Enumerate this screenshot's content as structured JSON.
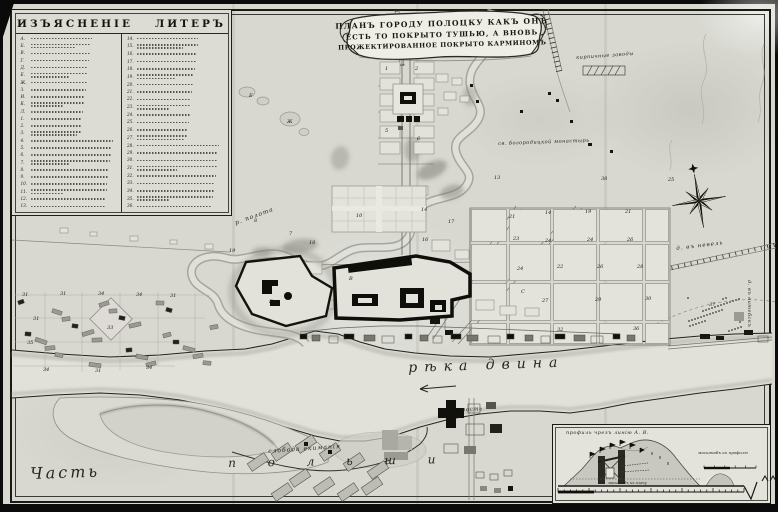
{
  "cartouche": {
    "line1": "ПЛАНЪ ГОРОДУ ПОЛОЦКУ КАКЪ ОНЪ",
    "line2": "ЕСТЬ ТО ПОКРЫТО ТУШЬЮ, А ВНОВЬ",
    "line3": "ПРОЖЕКТИРОВАННОЕ ПОКРЫТО КАРМИНОМЪ"
  },
  "legend": {
    "title_word1": "ИЗЪЯСНЕНІЕ",
    "title_word2": "ЛИТЕРЪ",
    "left_keys": [
      "А",
      "Б",
      "В",
      "Г",
      "Д",
      "Е",
      "Ж",
      "З",
      "И",
      "К",
      "Л",
      "1",
      "2",
      "3",
      "4",
      "5",
      "6",
      "7",
      "8",
      "9",
      "10",
      "11",
      "12",
      "13"
    ],
    "right_keys": [
      "14",
      "15",
      "16",
      "17",
      "18",
      "19",
      "20",
      "21",
      "22",
      "23",
      "24",
      "25",
      "26",
      "27",
      "28",
      "29",
      "30",
      "31",
      "32",
      "33",
      "34",
      "35",
      "36"
    ]
  },
  "map": {
    "labels": [
      {
        "t": "рѣка  двина",
        "x": 408,
        "y": 360,
        "s": 14,
        "ls": 7,
        "r": -2
      },
      {
        "t": "р. полота",
        "x": 234,
        "y": 220,
        "s": 6,
        "ls": 1,
        "r": -20
      },
      {
        "t": "слобода екиманія",
        "x": 268,
        "y": 448,
        "s": 6,
        "ls": 1,
        "r": -4
      },
      {
        "t": "Часть",
        "x": 30,
        "y": 464,
        "s": 16,
        "ls": 3,
        "r": -2
      },
      {
        "t": "п о л ь ш и",
        "x": 228,
        "y": 456,
        "s": 12,
        "ls": 14,
        "r": -1
      },
      {
        "t": "кирпичные заводы",
        "x": 576,
        "y": 55,
        "s": 5,
        "ls": 0.5,
        "r": -4
      },
      {
        "t": "д. въ невель",
        "x": 676,
        "y": 246,
        "s": 5.5,
        "ls": 1,
        "r": -7
      },
      {
        "t": "д. въ витебскъ",
        "x": 752,
        "y": 280,
        "s": 5,
        "ls": 0.5,
        "r": 90
      },
      {
        "t": "св. богородицкой монастырь",
        "x": 498,
        "y": 141,
        "s": 5,
        "ls": 0.5,
        "r": -2
      },
      {
        "t": "часть",
        "x": 462,
        "y": 407,
        "s": 5.5,
        "ls": 0.5,
        "r": -2
      }
    ],
    "numbers": [
      {
        "t": "31",
        "x": 22,
        "y": 292
      },
      {
        "t": "31",
        "x": 60,
        "y": 291
      },
      {
        "t": "34",
        "x": 98,
        "y": 291
      },
      {
        "t": "34",
        "x": 136,
        "y": 292
      },
      {
        "t": "31",
        "x": 170,
        "y": 293
      },
      {
        "t": "31",
        "x": 33,
        "y": 316
      },
      {
        "t": "33",
        "x": 107,
        "y": 325
      },
      {
        "t": "35",
        "x": 27,
        "y": 340
      },
      {
        "t": "34",
        "x": 43,
        "y": 367
      },
      {
        "t": "31",
        "x": 95,
        "y": 368
      },
      {
        "t": "34",
        "x": 146,
        "y": 365
      },
      {
        "t": "7",
        "x": 289,
        "y": 231
      },
      {
        "t": "8",
        "x": 254,
        "y": 218
      },
      {
        "t": "19",
        "x": 229,
        "y": 248
      },
      {
        "t": "18",
        "x": 309,
        "y": 240
      },
      {
        "t": "10",
        "x": 356,
        "y": 213
      },
      {
        "t": "14",
        "x": 421,
        "y": 207
      },
      {
        "t": "16",
        "x": 422,
        "y": 237
      },
      {
        "t": "17",
        "x": 448,
        "y": 219
      },
      {
        "t": "13",
        "x": 494,
        "y": 175
      },
      {
        "t": "38",
        "x": 601,
        "y": 176
      },
      {
        "t": "25",
        "x": 668,
        "y": 177
      },
      {
        "t": "21",
        "x": 509,
        "y": 214
      },
      {
        "t": "14",
        "x": 545,
        "y": 210
      },
      {
        "t": "19",
        "x": 585,
        "y": 209
      },
      {
        "t": "21",
        "x": 625,
        "y": 209
      },
      {
        "t": "23",
        "x": 513,
        "y": 236
      },
      {
        "t": "24",
        "x": 545,
        "y": 238
      },
      {
        "t": "24",
        "x": 587,
        "y": 237
      },
      {
        "t": "26",
        "x": 627,
        "y": 237
      },
      {
        "t": "24",
        "x": 517,
        "y": 266
      },
      {
        "t": "22",
        "x": 557,
        "y": 264
      },
      {
        "t": "26",
        "x": 597,
        "y": 264
      },
      {
        "t": "28",
        "x": 637,
        "y": 264
      },
      {
        "t": "27",
        "x": 542,
        "y": 298
      },
      {
        "t": "29",
        "x": 595,
        "y": 297
      },
      {
        "t": "30",
        "x": 645,
        "y": 296
      },
      {
        "t": "32",
        "x": 557,
        "y": 327
      },
      {
        "t": "36",
        "x": 633,
        "y": 326
      },
      {
        "t": "Е",
        "x": 249,
        "y": 93
      },
      {
        "t": "Ж",
        "x": 287,
        "y": 119
      },
      {
        "t": "4",
        "x": 401,
        "y": 96
      },
      {
        "t": "Б",
        "x": 269,
        "y": 299
      },
      {
        "t": "В",
        "x": 349,
        "y": 276
      },
      {
        "t": "С",
        "x": 521,
        "y": 289
      },
      {
        "t": "1",
        "x": 385,
        "y": 66
      },
      {
        "t": "2",
        "x": 415,
        "y": 66
      },
      {
        "t": "5",
        "x": 385,
        "y": 128
      },
      {
        "t": "6",
        "x": 417,
        "y": 136
      },
      {
        "t": "37",
        "x": 709,
        "y": 302
      }
    ]
  },
  "inset": {
    "title": "профиль чрезъ линію  А. В.",
    "scale_profile_label": "масштабъ къ профилю",
    "scale_plan_label": "масштабъ къ плану"
  },
  "colors": {
    "ink": "#1c1c16",
    "paper": "#d8d8d1",
    "shade": "#a8a8a0"
  }
}
